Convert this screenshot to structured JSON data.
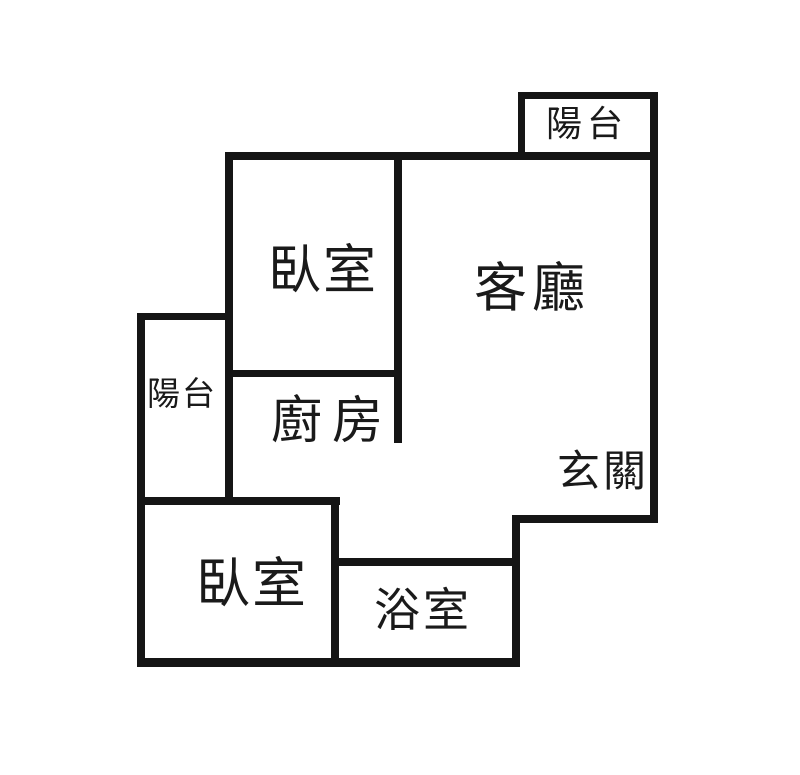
{
  "floorplan": {
    "background_color": "#ffffff",
    "wall_color": "#151515",
    "text_color": "#1a1a1a",
    "rooms": {
      "balcony_top_right": {
        "label": "陽台"
      },
      "bedroom_upper": {
        "label": "臥室"
      },
      "living_room": {
        "label": "客廳"
      },
      "balcony_left": {
        "label": "陽台"
      },
      "kitchen": {
        "label": "廚房"
      },
      "entrance": {
        "label": "玄關"
      },
      "bedroom_lower": {
        "label": "臥室"
      },
      "bathroom": {
        "label": "浴室"
      }
    }
  }
}
